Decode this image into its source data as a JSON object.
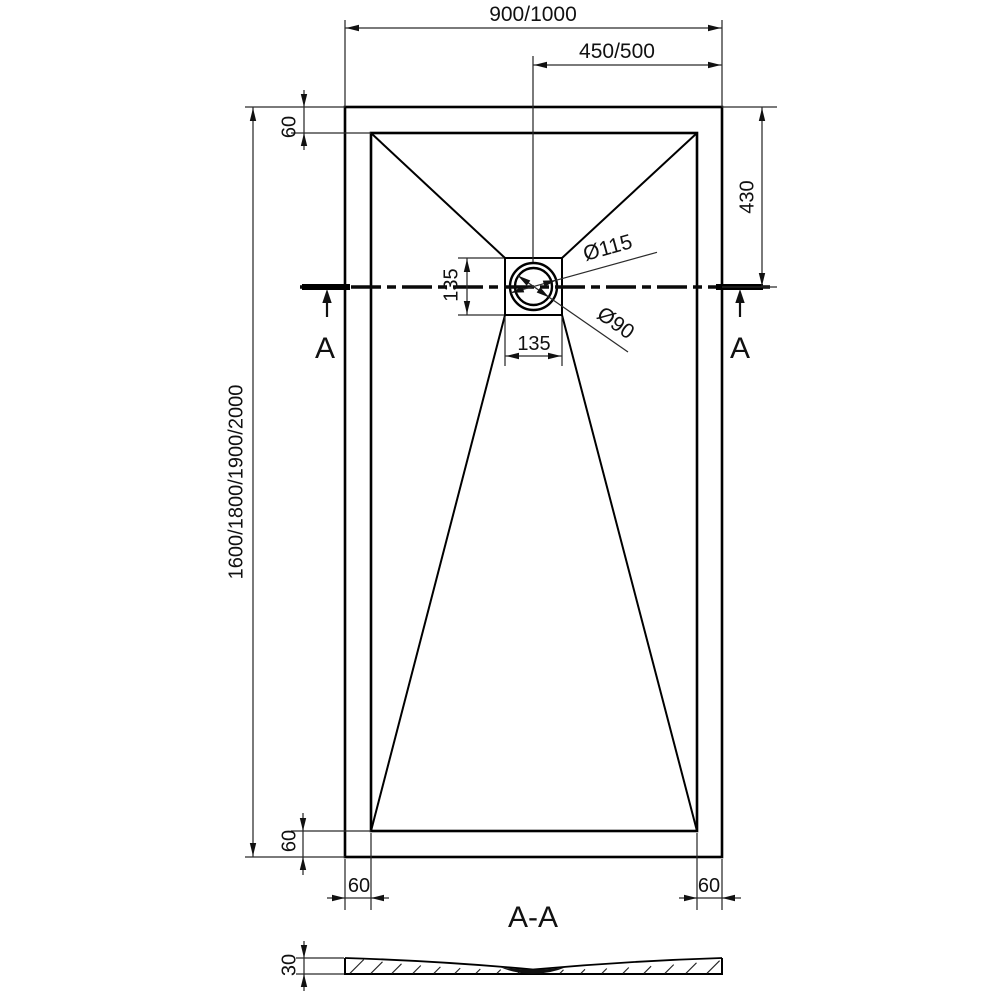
{
  "drawing": {
    "plan": {
      "overall_width": "900/1000",
      "half_width": "450/500",
      "overall_length": "1600/1800/1900/2000",
      "rim_top": "60",
      "rim_bottom": "60",
      "rim_bottom_left": "60",
      "rim_bottom_right": "60",
      "drain_offset_from_top": "430",
      "drain_box_height": "135",
      "drain_box_width": "135",
      "drain_outer_diameter": "Ø115",
      "drain_inner_diameter": "Ø90",
      "section_letter_left": "A",
      "section_letter_right": "A"
    },
    "section": {
      "title": "A-A",
      "thickness": "30"
    },
    "colors": {
      "background": "#ffffff",
      "line_thin": "#2b2b2b",
      "line_bold": "#000000",
      "text": "#111111"
    }
  }
}
